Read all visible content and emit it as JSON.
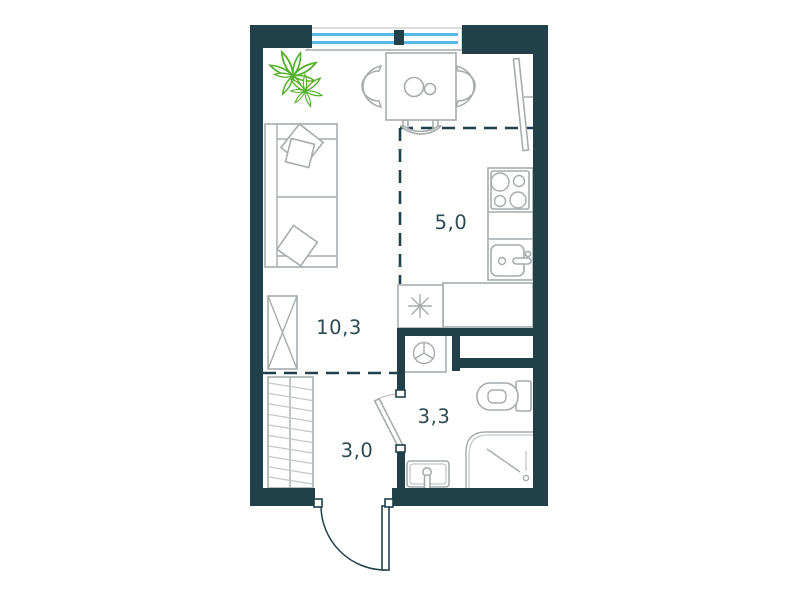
{
  "title": "studio-apartment-floor-plan",
  "labels": {
    "living": "10,3",
    "kitchen": "5,0",
    "hallway": "3,0",
    "bathroom": "3,3"
  },
  "rooms": [
    {
      "name": "living-room",
      "area_label": "10,3"
    },
    {
      "name": "kitchen",
      "area_label": "5,0"
    },
    {
      "name": "hallway",
      "area_label": "3,0"
    },
    {
      "name": "bathroom",
      "area_label": "3,3"
    }
  ],
  "fixtures": [
    "window",
    "plant-icon",
    "dining-table",
    "chair",
    "sofa",
    "pillow",
    "wardrobe",
    "coat-closet-hangers",
    "fridge-snowflake-icon",
    "kitchen-counter",
    "stove-burners",
    "kitchen-sink",
    "washing-machine",
    "toilet",
    "shower",
    "bathroom-sink",
    "entrance-door",
    "bathroom-door",
    "door-leaf-panel",
    "zoning-dashed-line",
    "ventilation-shaft"
  ],
  "colors": {
    "wall": "#21404A",
    "window_glass": "#56B9E7",
    "plant": "#55AF2B",
    "furniture_outline": "#A7ABAD",
    "label_text": "#2D4B53",
    "background": "#FFFFFF"
  }
}
